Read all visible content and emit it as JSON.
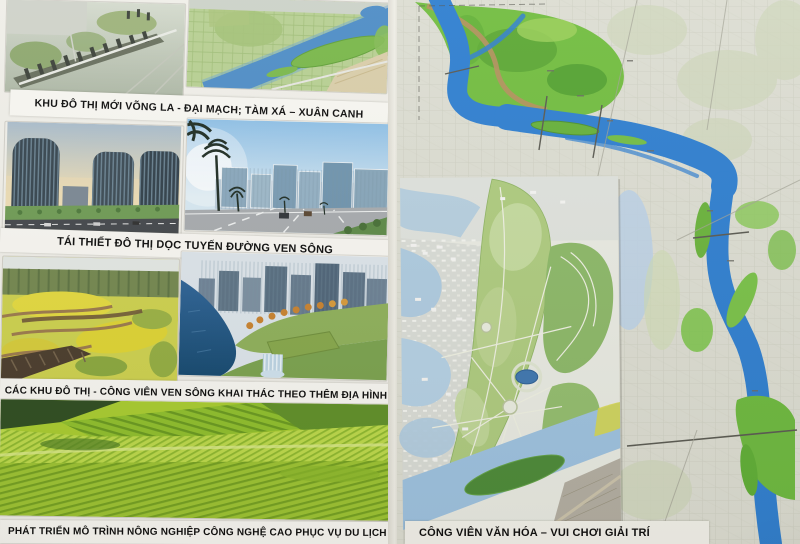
{
  "poster": {
    "captions": {
      "new_urban_areas": "KHU ĐÔ THỊ MỚI VÕNG LA - ĐẠI MẠCH; TÀM XÁ – XUÂN CANH",
      "rebuild_riverside": "TÁI THIẾT ĐÔ THỊ DỌC TUYẾN ĐƯỜNG VEN SÔNG",
      "terrain_parks": "CÁC KHU ĐÔ THỊ - CÔNG VIÊN VEN SÔNG KHAI THÁC THEO THÊM ĐỊA HÌNH",
      "agriculture": "PHÁT TRIỂN MÔ TRÌNH NÔNG NGHIỆP CÔNG NGHỆ CAO PHỤC VỤ DU LỊCH"
    }
  },
  "map": {
    "caption": "CÔNG VIÊN VĂN HÓA – VUI CHƠI GIẢI TRÍ"
  },
  "colors": {
    "river_blue": "#2f7fd0",
    "floodplain_green": "#6fbf3e",
    "map_base": "#dcddd2",
    "caption_bg": "#f7f6f1",
    "caption_text": "#0d0d0d",
    "farm_field_green": "#a8cc2f",
    "flower_yellow": "#ddd23a"
  }
}
